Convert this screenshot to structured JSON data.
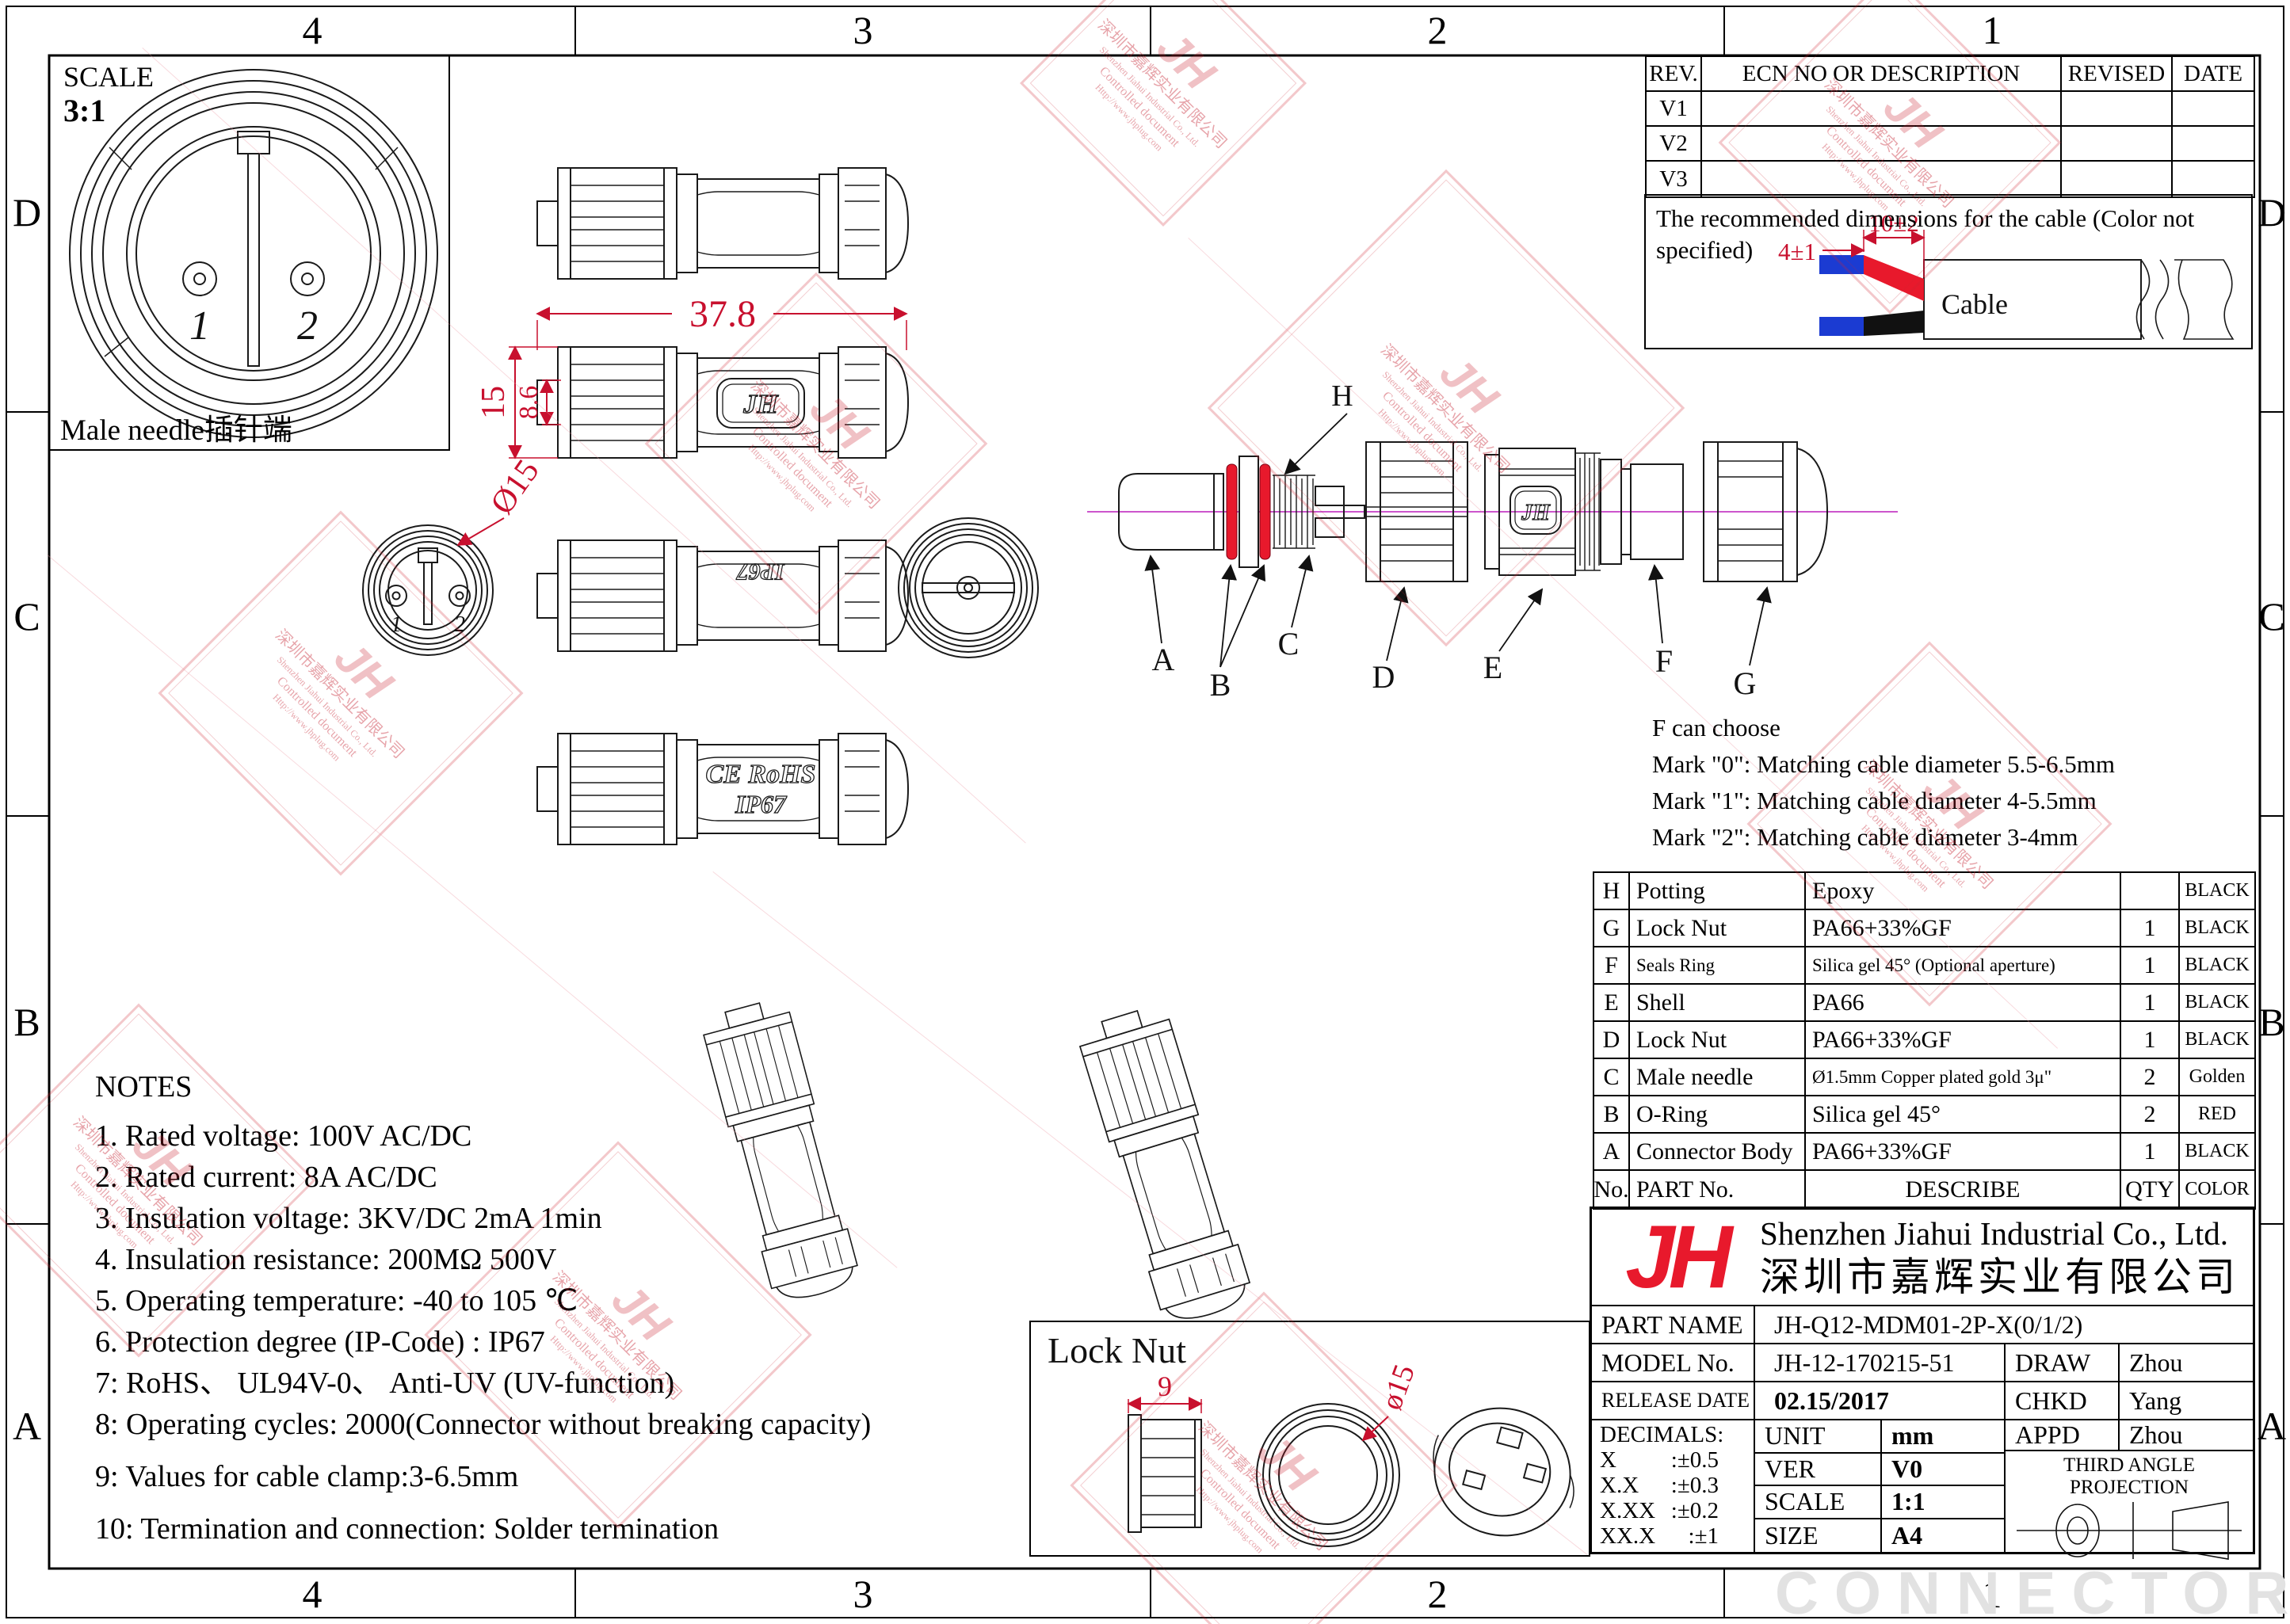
{
  "zones": {
    "cols": [
      "4",
      "3",
      "2",
      "1"
    ],
    "rows": [
      "D",
      "C",
      "B",
      "A"
    ]
  },
  "scale_box": {
    "label": "SCALE",
    "value": "3:1",
    "pin1": "1",
    "pin2": "2",
    "caption": "Male needle插针端"
  },
  "revision_table": {
    "headers": [
      "REV.",
      "ECN NO OR DESCRIPTION",
      "REVISED",
      "DATE"
    ],
    "rows": [
      "V1",
      "V2",
      "V3"
    ]
  },
  "cable_note": {
    "text": "The recommended dimensions for the cable  (Color not specified)",
    "dim_a": "4±1",
    "dim_b": "10±2",
    "cable_label": "Cable"
  },
  "dims": {
    "length": "37.8",
    "height": "15",
    "inner_height": "8.6",
    "front_dia": "Ø15",
    "locknut_w": "9",
    "locknut_dia": "ø15"
  },
  "markings": {
    "logo": "JH",
    "ip67_top": "IP67",
    "ce_rohs": "CE RoHS",
    "ip67": "IP67"
  },
  "exploded": {
    "h": "H",
    "a": "A",
    "b": "B",
    "c": "C",
    "d": "D",
    "e": "E",
    "f": "F",
    "g": "G"
  },
  "f_choose": {
    "line1": "F can choose",
    "line2": "Mark \"0\": Matching cable diameter 5.5-6.5mm",
    "line3": "Mark \"1\": Matching cable diameter 4-5.5mm",
    "line4": "Mark \"2\": Matching cable diameter 3-4mm"
  },
  "parts_table": {
    "rows": [
      {
        "no": "H",
        "part": "Potting",
        "desc": "Epoxy",
        "qty": "",
        "color": "BLACK"
      },
      {
        "no": "G",
        "part": "Lock Nut",
        "desc": "PA66+33%GF",
        "qty": "1",
        "color": "BLACK"
      },
      {
        "no": "F",
        "part": "Seals Ring",
        "desc": "Silica gel 45°  (Optional aperture)",
        "qty": "1",
        "color": "BLACK"
      },
      {
        "no": "E",
        "part": "Shell",
        "desc": "PA66",
        "qty": "1",
        "color": "BLACK"
      },
      {
        "no": "D",
        "part": "Lock Nut",
        "desc": "PA66+33%GF",
        "qty": "1",
        "color": "BLACK"
      },
      {
        "no": "C",
        "part": "Male needle",
        "desc": "Ø1.5mm Copper plated gold 3μ\"",
        "qty": "2",
        "color": "Golden"
      },
      {
        "no": "B",
        "part": "O-Ring",
        "desc": "Silica gel 45°",
        "qty": "2",
        "color": "RED"
      },
      {
        "no": "A",
        "part": "Connector Body",
        "desc": "PA66+33%GF",
        "qty": "1",
        "color": "BLACK"
      }
    ],
    "footer": {
      "no": "No.",
      "part": "PART No.",
      "desc": "DESCRIBE",
      "qty": "QTY",
      "color": "COLOR"
    }
  },
  "notes": {
    "title": "NOTES",
    "items": [
      "1. Rated voltage: 100V AC/DC",
      "2. Rated current: 8A AC/DC",
      "3. Insulation voltage: 3KV/DC 2mA 1min",
      "4. Insulation resistance: 200MΩ 500V",
      "5. Operating temperature: -40 to 105 ℃",
      "6. Protection degree (IP-Code) : IP67",
      "7: RoHS、 UL94V-0、 Anti-UV (UV-function)",
      "8: Operating cycles: 2000(Connector without breaking capacity)",
      "9: Values for cable clamp:3-6.5mm",
      "10: Termination and connection: Solder termination"
    ]
  },
  "lock_nut_box": {
    "title": "Lock Nut"
  },
  "title_block": {
    "logo": "JH",
    "company_en": "Shenzhen Jiahui Industrial Co., Ltd.",
    "company_cn": "深圳市嘉辉实业有限公司",
    "part_name_label": "PART NAME",
    "part_name": "JH-Q12-MDM01-2P-X(0/1/2)",
    "model_label": "MODEL No.",
    "model": "JH-12-170215-51",
    "draw_label": "DRAW",
    "draw": "Zhou",
    "release_label": "RELEASE DATE",
    "release": "02.15/2017",
    "chkd_label": "CHKD",
    "chkd": "Yang",
    "decimals_label": "DECIMALS:",
    "decimals": [
      [
        "X",
        ":±0.5"
      ],
      [
        "X.X",
        ":±0.3"
      ],
      [
        "X.XX",
        ":±0.2"
      ],
      [
        "XX.X",
        ":±1"
      ]
    ],
    "unit_label": "UNIT",
    "unit": "mm",
    "appd_label": "APPD",
    "appd": "Zhou",
    "ver_label": "VER",
    "ver": "V0",
    "projection": "THIRD ANGLE PROJECTION",
    "scale_label": "SCALE",
    "scale": "1:1",
    "size_label": "SIZE",
    "size": "A4"
  },
  "watermark": {
    "jh": "JH",
    "company_cn": "深圳市嘉辉实业有限公司",
    "company_en": "Shenzhen Jiahui Industrial Co., Ltd.",
    "controlled": "Controlled document",
    "url": "Http://www.jhplug.com",
    "connector": "CONNECTOR"
  },
  "colors": {
    "red_dim": "#c8102e",
    "logo_red": "#e8192c",
    "centerline": "#cc55cc",
    "wire_blue": "#1b3bd2",
    "wire_red": "#e8192c",
    "wire_black": "#111111"
  }
}
